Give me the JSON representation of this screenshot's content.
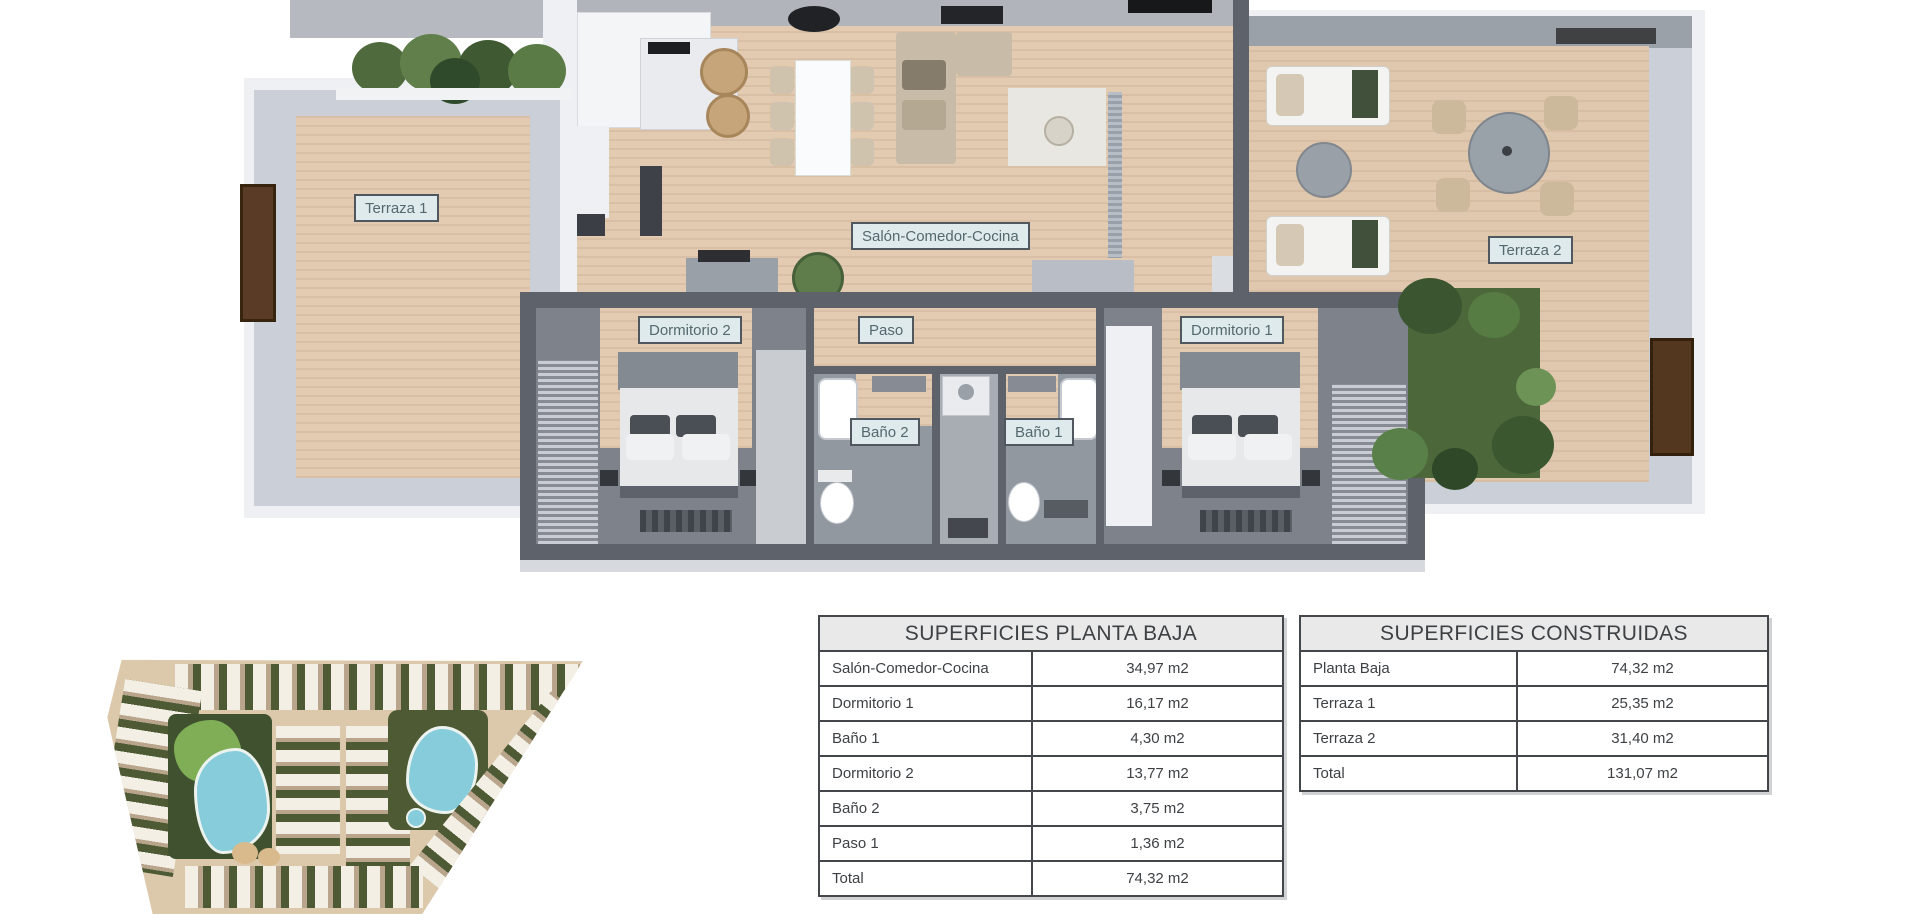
{
  "floorplan": {
    "labels": {
      "terraza1": "Terraza 1",
      "salon": "Salón-Comedor-Cocina",
      "terraza2": "Terraza 2",
      "dormitorio2": "Dormitorio 2",
      "paso": "Paso",
      "dormitorio1": "Dormitorio 1",
      "bano2": "Baño 2",
      "bano1": "Baño 1"
    }
  },
  "tables": {
    "planta_baja": {
      "title": "SUPERFICIES PLANTA BAJA",
      "rows": [
        {
          "label": "Salón-Comedor-Cocina",
          "value": "34,97 m2"
        },
        {
          "label": "Dormitorio 1",
          "value": "16,17 m2"
        },
        {
          "label": "Baño 1",
          "value": "4,30 m2"
        },
        {
          "label": "Dormitorio 2",
          "value": "13,77 m2"
        },
        {
          "label": "Baño 2",
          "value": "3,75 m2"
        },
        {
          "label": "Paso 1",
          "value": "1,36 m2"
        },
        {
          "label": "Total",
          "value": "74,32 m2"
        }
      ]
    },
    "construidas": {
      "title": "SUPERFICIES CONSTRUIDAS",
      "rows": [
        {
          "label": "Planta Baja",
          "value": "74,32 m2"
        },
        {
          "label": "Terraza 1",
          "value": "25,35 m2"
        },
        {
          "label": "Terraza 2",
          "value": "31,40 m2"
        },
        {
          "label": "Total",
          "value": "131,07 m2"
        }
      ]
    }
  },
  "colors": {
    "wall_dark": "#5d626b",
    "wall_band": "#cbd0d8",
    "wood_floor": "#e3cbb2",
    "label_bg": "#dfeaed",
    "label_text": "#54696d",
    "pool_blue": "#86ccdb",
    "garden_green": "#4c673a",
    "table_border": "#43464a",
    "table_header_bg": "#e9e9ea"
  }
}
